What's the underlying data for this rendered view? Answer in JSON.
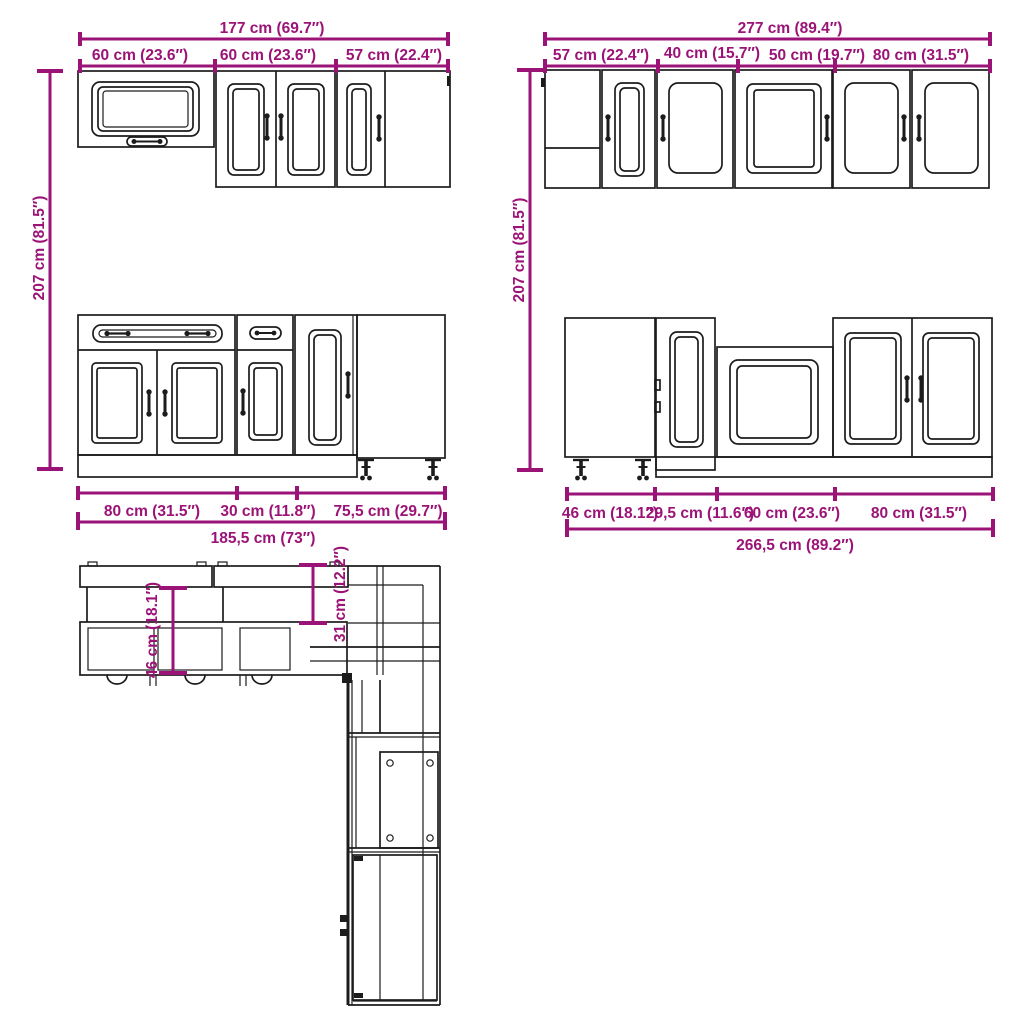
{
  "colors": {
    "dimension": "#9B1377",
    "linework": "#1C1C1C",
    "background": "#FFFFFF"
  },
  "dims": {
    "wall_run_left": {
      "total": "177 cm (69.7″)",
      "segments": [
        "60 cm (23.6″)",
        "60 cm (23.6″)",
        "57 cm (22.4″)"
      ]
    },
    "wall_run_right": {
      "total": "277 cm (89.4″)",
      "segments": [
        "57 cm (22.4″)",
        "40 cm (15.7″)",
        "50 cm (19.7″)",
        "80 cm (31.5″)"
      ]
    },
    "height_left": "207 cm (81.5″)",
    "height_right": "207 cm (81.5″)",
    "base_run_left": {
      "total": "185,5 cm (73″)",
      "segments": [
        "80 cm (31.5″)",
        "30 cm (11.8″)",
        "75,5 cm (29.7″)"
      ]
    },
    "base_run_right": {
      "total": "266,5 cm (89.2″)",
      "segments": [
        "46 cm (18.1″)",
        "29,5 cm (11.6″)",
        "60 cm (23.6″)",
        "80 cm (31.5″)"
      ]
    },
    "plan_view": {
      "base_depth": "46 cm (18.1″)",
      "wall_depth": "31 cm (12.2″)"
    }
  }
}
